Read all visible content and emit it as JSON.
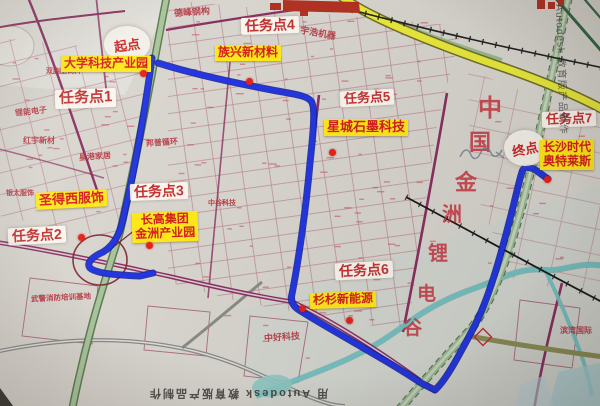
{
  "start": {
    "label": "起点"
  },
  "end": {
    "label": "终点"
  },
  "tasks": [
    {
      "label": "任务点1"
    },
    {
      "label": "任务点2"
    },
    {
      "label": "任务点3"
    },
    {
      "label": "任务点4"
    },
    {
      "label": "任务点5"
    },
    {
      "label": "任务点6"
    },
    {
      "label": "任务点7"
    }
  ],
  "pois": [
    {
      "label": "大学科技产业园"
    },
    {
      "label": "族兴新材料"
    },
    {
      "label": "星城石墨科技"
    },
    {
      "label": "圣得西服饰"
    },
    {
      "line1": "长高集团",
      "line2": "金洲产业园"
    },
    {
      "label": "杉杉新能源"
    },
    {
      "line1": "长沙时代",
      "line2": "奥特莱斯"
    }
  ],
  "map_texts": {
    "defeng_steel": "德峰钢构",
    "yuhao_machinery": "宇浩机器",
    "shuangbaotai_feed": "双胞胎饲料",
    "lineng_electronics": "锂能电子",
    "hongyu_materials": "红宇新材",
    "xinggang_furniture": "星港家居",
    "bangpu_recycling": "邦普循环",
    "yintai_clothing": "银太服饰",
    "wujing_fire_training": "武警消防培训基地",
    "zhonghao_tech": "中好科技",
    "zhonggu_tech": "中谷科技",
    "binwan_intl": "滨湾国际"
  },
  "district": {
    "chars": [
      "中",
      "国",
      "金",
      "洲",
      "锂",
      "电",
      "谷"
    ]
  },
  "watermarks": {
    "bottom": "用 Autodesk 教育版产品制作",
    "right": "Autodesk 教育版产品制作"
  },
  "colors": {
    "route_blue": "#2336e2",
    "highlight_yellow": "#ffe81a",
    "label_red": "#c23434",
    "marker_red": "#e6231c",
    "road_yellow": "#e9e93c"
  }
}
